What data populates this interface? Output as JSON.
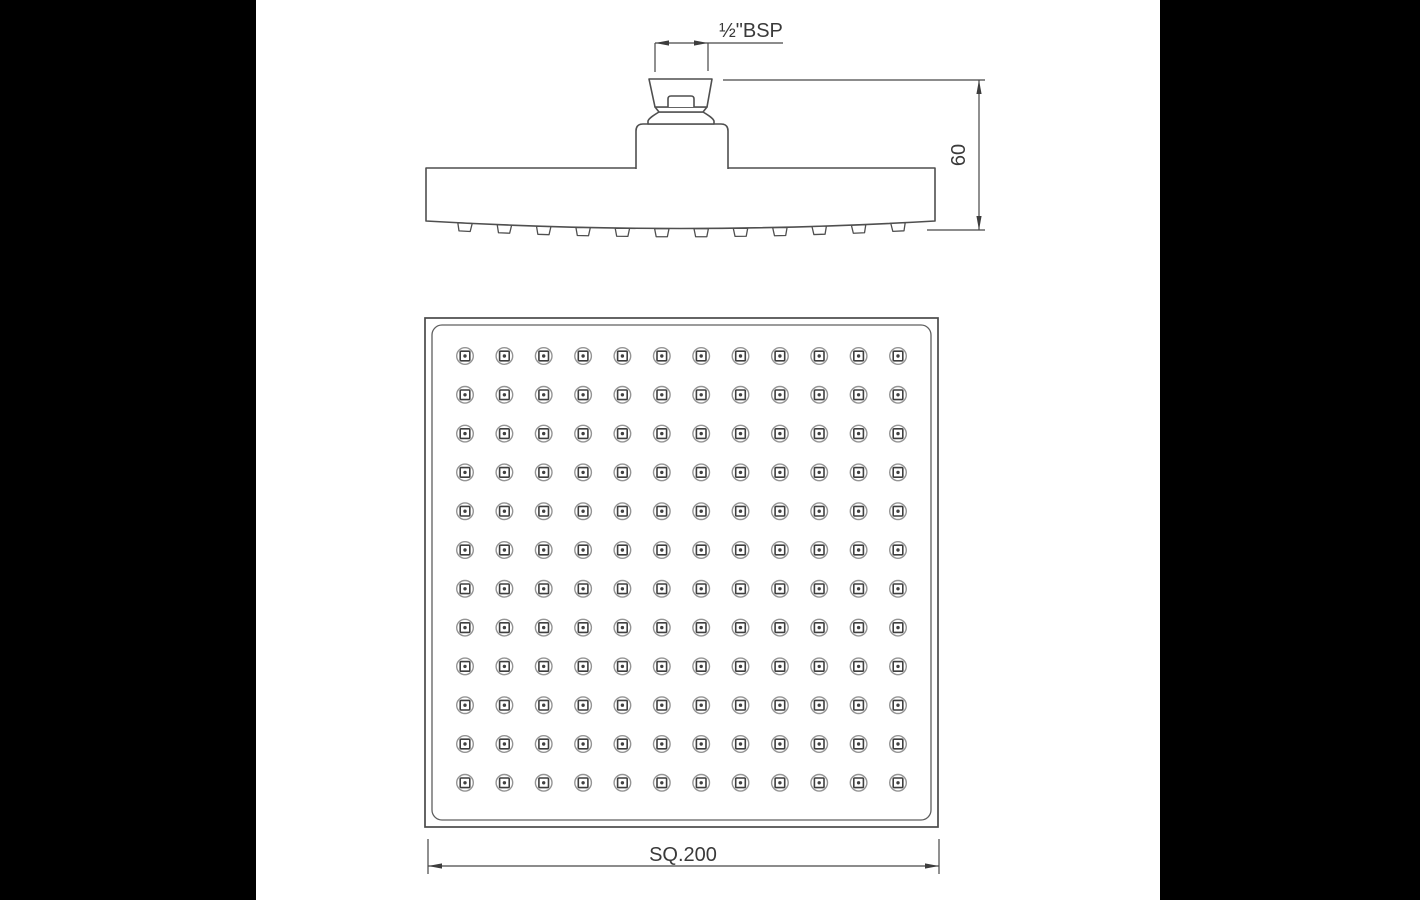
{
  "scene": {
    "background_color": "#000000",
    "sheet_color": "#ffffff",
    "line_color": "#4f4f4f",
    "text_color": "#3a3a3a"
  },
  "drawing": {
    "type": "technical-drawing",
    "subject": "square overhead shower head, two-view dimensioned drawing",
    "labels": {
      "thread": "½\"BSP",
      "height": "60",
      "width": "SQ.200"
    },
    "side_view": {
      "name": "side-elevation",
      "nozzle_count": 12
    },
    "face_view": {
      "name": "spray-face",
      "grid": {
        "rows": 12,
        "cols": 12
      },
      "nozzle_total": 144
    }
  }
}
